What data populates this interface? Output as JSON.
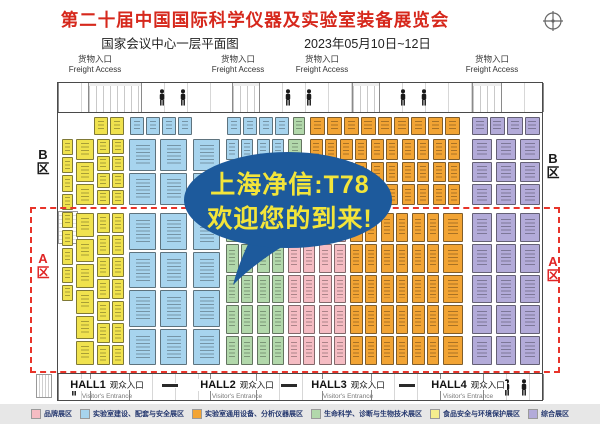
{
  "header": {
    "title": "第二十届中国国际科学仪器及实验室装备展览会",
    "title_color": "#d6281c",
    "subtitle_left": "国家会议中心一层平面图",
    "subtitle_right": "2023年05月10日~12日"
  },
  "bubble": {
    "line1": "上海净信:T78",
    "line2": "欢迎您的到来!",
    "bg_color": "#1d5a9c",
    "text_color": "#f3e53a"
  },
  "map": {
    "freight_label": {
      "cn": "货物入口",
      "en": "Freight Access"
    },
    "freight_positions": [
      95,
      238,
      322,
      492
    ],
    "visitor_label": {
      "cn": "观众入口",
      "en": "Visitor's Entrance"
    },
    "halls": [
      {
        "name": "HALL1",
        "x": 107
      },
      {
        "name": "HALL2",
        "x": 237
      },
      {
        "name": "HALL3",
        "x": 348
      },
      {
        "name": "HALL4",
        "x": 468
      }
    ],
    "area_labels": [
      {
        "text": "B",
        "sub": "区",
        "x": 43,
        "y": 148,
        "color": "#1a1a1a"
      },
      {
        "text": "B",
        "sub": "区",
        "x": 553,
        "y": 152,
        "color": "#1a1a1a"
      },
      {
        "text": "A",
        "sub": "区",
        "x": 43,
        "y": 252,
        "color": "#e02525"
      },
      {
        "text": "A",
        "sub": "区",
        "x": 553,
        "y": 255,
        "color": "#e02525"
      }
    ],
    "a_zone_border_color": "#e8342a",
    "booth_colors": {
      "yellow": "#f0e24e",
      "blue": "#a7d4ee",
      "green": "#b2d8ab",
      "orange": "#f2a434",
      "pink": "#f5bcc3",
      "purple": "#b3abd9"
    },
    "booth_zones": [
      {
        "x": 94,
        "y": 117,
        "w": 30,
        "h": 18,
        "cols": 2,
        "rows": 1,
        "c": "yellow"
      },
      {
        "x": 130,
        "y": 117,
        "w": 62,
        "h": 18,
        "cols": 4,
        "rows": 1,
        "c": "blue"
      },
      {
        "x": 227,
        "y": 117,
        "w": 62,
        "h": 18,
        "cols": 4,
        "rows": 1,
        "c": "blue"
      },
      {
        "x": 293,
        "y": 117,
        "w": 12,
        "h": 18,
        "cols": 1,
        "rows": 1,
        "c": "green"
      },
      {
        "x": 310,
        "y": 117,
        "w": 150,
        "h": 18,
        "cols": 9,
        "rows": 1,
        "c": "orange"
      },
      {
        "x": 472,
        "y": 117,
        "w": 68,
        "h": 18,
        "cols": 4,
        "rows": 1,
        "c": "purple"
      },
      {
        "x": 62,
        "y": 139,
        "w": 11,
        "h": 162,
        "cols": 1,
        "rows": 9,
        "c": "yellow"
      },
      {
        "x": 76,
        "y": 139,
        "w": 18,
        "h": 66,
        "cols": 1,
        "rows": 3,
        "c": "yellow"
      },
      {
        "x": 97,
        "y": 139,
        "w": 27,
        "h": 66,
        "cols": 2,
        "rows": 4,
        "c": "yellow"
      },
      {
        "x": 129,
        "y": 139,
        "w": 27,
        "h": 66,
        "cols": 1,
        "rows": 2,
        "c": "blue"
      },
      {
        "x": 160,
        "y": 139,
        "w": 27,
        "h": 66,
        "cols": 1,
        "rows": 2,
        "c": "blue"
      },
      {
        "x": 193,
        "y": 139,
        "w": 27,
        "h": 66,
        "cols": 1,
        "rows": 2,
        "c": "blue"
      },
      {
        "x": 226,
        "y": 139,
        "w": 27,
        "h": 66,
        "cols": 2,
        "rows": 3,
        "c": "blue"
      },
      {
        "x": 257,
        "y": 139,
        "w": 27,
        "h": 66,
        "cols": 2,
        "rows": 3,
        "c": "blue"
      },
      {
        "x": 288,
        "y": 139,
        "w": 14,
        "h": 66,
        "cols": 1,
        "rows": 3,
        "c": "green"
      },
      {
        "x": 310,
        "y": 139,
        "w": 27,
        "h": 66,
        "cols": 2,
        "rows": 3,
        "c": "orange"
      },
      {
        "x": 340,
        "y": 139,
        "w": 27,
        "h": 66,
        "cols": 2,
        "rows": 3,
        "c": "orange"
      },
      {
        "x": 371,
        "y": 139,
        "w": 27,
        "h": 66,
        "cols": 2,
        "rows": 3,
        "c": "orange"
      },
      {
        "x": 402,
        "y": 139,
        "w": 27,
        "h": 66,
        "cols": 2,
        "rows": 3,
        "c": "orange"
      },
      {
        "x": 433,
        "y": 139,
        "w": 27,
        "h": 66,
        "cols": 2,
        "rows": 3,
        "c": "orange"
      },
      {
        "x": 472,
        "y": 139,
        "w": 20,
        "h": 66,
        "cols": 1,
        "rows": 3,
        "c": "purple"
      },
      {
        "x": 496,
        "y": 139,
        "w": 20,
        "h": 66,
        "cols": 1,
        "rows": 3,
        "c": "purple"
      },
      {
        "x": 520,
        "y": 139,
        "w": 20,
        "h": 66,
        "cols": 1,
        "rows": 3,
        "c": "purple"
      },
      {
        "x": 76,
        "y": 213,
        "w": 18,
        "h": 152,
        "cols": 1,
        "rows": 6,
        "c": "yellow"
      },
      {
        "x": 97,
        "y": 213,
        "w": 27,
        "h": 152,
        "cols": 2,
        "rows": 7,
        "c": "yellow"
      },
      {
        "x": 129,
        "y": 213,
        "w": 27,
        "h": 152,
        "cols": 1,
        "rows": 4,
        "c": "blue"
      },
      {
        "x": 160,
        "y": 213,
        "w": 27,
        "h": 152,
        "cols": 1,
        "rows": 4,
        "c": "blue"
      },
      {
        "x": 193,
        "y": 213,
        "w": 27,
        "h": 152,
        "cols": 1,
        "rows": 4,
        "c": "blue"
      },
      {
        "x": 226,
        "y": 213,
        "w": 27,
        "h": 152,
        "cols": 2,
        "rows": 5,
        "c": "green"
      },
      {
        "x": 257,
        "y": 213,
        "w": 27,
        "h": 152,
        "cols": 2,
        "rows": 5,
        "c": "green"
      },
      {
        "x": 288,
        "y": 213,
        "w": 27,
        "h": 152,
        "cols": 2,
        "rows": 5,
        "c": "pink"
      },
      {
        "x": 319,
        "y": 213,
        "w": 27,
        "h": 152,
        "cols": 2,
        "rows": 5,
        "c": "pink"
      },
      {
        "x": 350,
        "y": 213,
        "w": 27,
        "h": 152,
        "cols": 2,
        "rows": 5,
        "c": "orange"
      },
      {
        "x": 381,
        "y": 213,
        "w": 27,
        "h": 152,
        "cols": 2,
        "rows": 5,
        "c": "orange"
      },
      {
        "x": 412,
        "y": 213,
        "w": 27,
        "h": 152,
        "cols": 2,
        "rows": 5,
        "c": "orange"
      },
      {
        "x": 443,
        "y": 213,
        "w": 20,
        "h": 152,
        "cols": 1,
        "rows": 5,
        "c": "orange"
      },
      {
        "x": 472,
        "y": 213,
        "w": 20,
        "h": 152,
        "cols": 1,
        "rows": 5,
        "c": "purple"
      },
      {
        "x": 496,
        "y": 213,
        "w": 20,
        "h": 152,
        "cols": 1,
        "rows": 5,
        "c": "purple"
      },
      {
        "x": 520,
        "y": 213,
        "w": 20,
        "h": 152,
        "cols": 1,
        "rows": 5,
        "c": "purple"
      }
    ],
    "top_strip_rooms": [
      [
        0,
        31
      ],
      [
        83,
        92
      ],
      [
        201,
        94
      ],
      [
        321,
        94
      ],
      [
        443,
        43
      ]
    ],
    "top_strip_docks": [
      [
        31,
        52
      ],
      [
        175,
        26
      ],
      [
        295,
        26
      ],
      [
        415,
        28
      ]
    ],
    "bottom_strip_rooms": [
      [
        0,
        33
      ],
      [
        71,
        82
      ],
      [
        198,
        67
      ],
      [
        313,
        70
      ],
      [
        425,
        61
      ]
    ],
    "door_bar_positions": [
      103,
      222,
      340
    ],
    "persons_top": [
      100,
      121,
      226,
      247,
      341,
      362
    ],
    "persons_bottom": [
      12,
      445,
      462
    ]
  },
  "legend": {
    "items": [
      {
        "label": "品牌展区",
        "color": "#f5bcc3"
      },
      {
        "label": "实验室建设、配套与安全展区",
        "color": "#a7d4ee"
      },
      {
        "label": "实验室通用设备、分析仪器展区",
        "color": "#f2a434"
      },
      {
        "label": "生命科学、诊断与生物技术展区",
        "color": "#b2d8ab"
      },
      {
        "label": "食品安全与环境保护展区",
        "color": "#f5ee8e"
      },
      {
        "label": "综合展区",
        "color": "#b3abd9"
      }
    ]
  }
}
